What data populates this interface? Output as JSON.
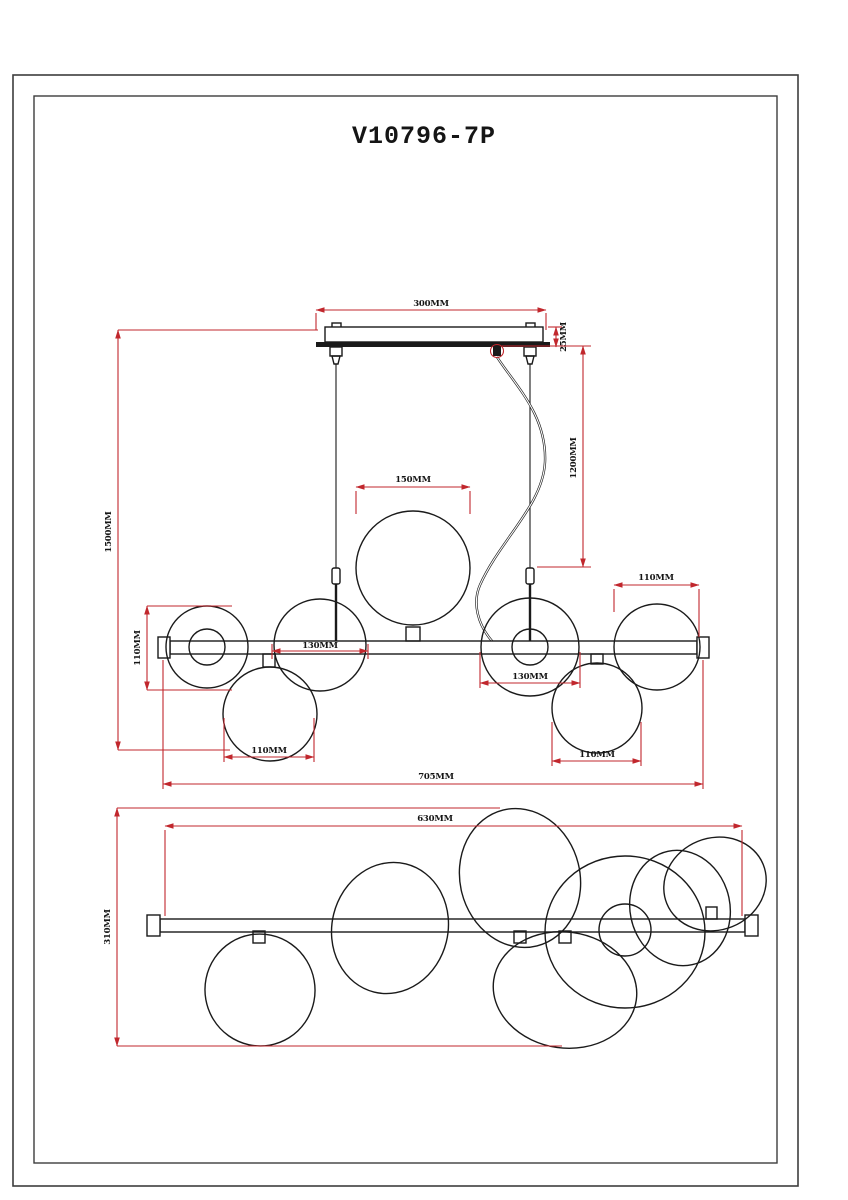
{
  "title": "V10796-7P",
  "colors": {
    "dimension_line": "#c1272d",
    "drawing_line": "#1a1a1a",
    "background": "#ffffff"
  },
  "front_view": {
    "dims": {
      "canopy_width": "300MM",
      "canopy_thickness": "25MM",
      "overall_height": "1500MM",
      "cord_length": "1200MM",
      "center_globe_diameter": "150MM",
      "left_globe_diameter": "110MM",
      "left_globe_spacing": "130MM",
      "lower_left_globe_diameter": "110MM",
      "right_globe_diameter": "110MM",
      "right_globe_spacing": "130MM",
      "lower_right_globe_diameter": "110MM",
      "overall_length": "705MM"
    }
  },
  "bottom_view": {
    "dims": {
      "frame_length": "630MM",
      "overall_depth": "310MM"
    }
  }
}
